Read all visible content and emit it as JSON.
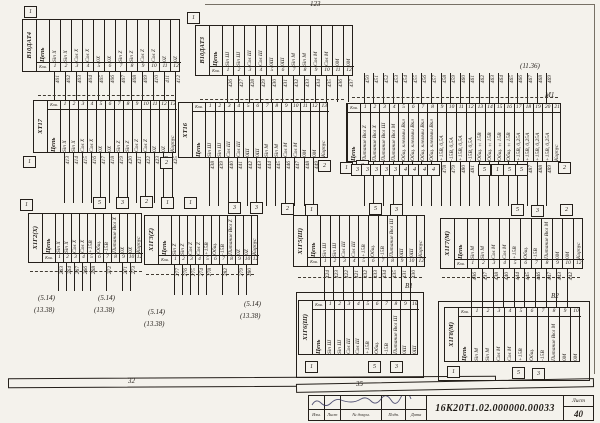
{
  "sheet": {
    "doc_number": "16К20Т1.02.000000.00033",
    "sheet_label": "Лист",
    "sheet_number": "40",
    "stamp_cols": [
      "Изм.",
      "Лист",
      "№ докум.",
      "Подп.",
      "Дата"
    ],
    "ink_color": "#241f1a",
    "paper_color": "#f4f2ec"
  },
  "tables": [
    {
      "id": "v10dat4",
      "name": "В10ДАТ4",
      "x": 22,
      "y": 19,
      "colw": 11,
      "body_h": 44,
      "pin_row": 9,
      "pins_side": "bottom",
      "header": "Цепь",
      "pin_header": "Кон.",
      "pins": [
        "1",
        "2",
        "3",
        "4",
        "5",
        "6",
        "7",
        "8",
        "9",
        "10",
        "11",
        "12"
      ],
      "circuits": [
        "Sin X",
        "Sin X",
        "Cos X",
        "Cos X",
        "0X",
        "0X",
        "Sin Z",
        "Sin Z",
        "Cos Z",
        "Cos Z",
        "0Z",
        "0Z"
      ],
      "wires_top": null,
      "wires_bottom": {
        "len": 28,
        "nums": [
          "401",
          "402",
          "403",
          "404",
          "405",
          "406",
          "407",
          "408",
          "409",
          "410",
          "411",
          "412"
        ]
      }
    },
    {
      "id": "v10dat3",
      "name": "В10ДАТ3",
      "x": 195,
      "y": 25,
      "colw": 11,
      "body_h": 42,
      "pin_row": 9,
      "pins_side": "bottom",
      "header": "Цепь",
      "pin_header": "Кон.",
      "pins": [
        "1",
        "2",
        "3",
        "4",
        "5",
        "6",
        "7",
        "8",
        "9",
        "10",
        "11",
        "12"
      ],
      "circuits": [
        "Sin Ш",
        "Sin Ш",
        "Cos Ш",
        "Cos Ш",
        "0Ш",
        "0Ш",
        "Sin M",
        "Sin M",
        "Cos M",
        "Cos M",
        "0M",
        "0M"
      ],
      "wires_top": null,
      "wires_bottom": {
        "len": 26,
        "nums": [
          "426",
          "427",
          "428",
          "429",
          "430",
          "431",
          "432",
          "433",
          "434",
          "435",
          "436",
          "437"
        ]
      }
    },
    {
      "id": "xt17",
      "name": "ХТ17",
      "x": 33,
      "y": 100,
      "colw": 9,
      "body_h": 44,
      "pin_row": 9,
      "pins_side": "top",
      "header": "Цепь",
      "pin_header": "Кон.",
      "pins": [
        "1",
        "2",
        "3",
        "4",
        "5",
        "6",
        "7",
        "8",
        "9",
        "10",
        "11",
        "12",
        "13"
      ],
      "circuits": [
        "Sin X",
        "Sin X",
        "Cos X",
        "Cos X",
        "0X",
        "0X",
        "Sin Z",
        "Sin Z",
        "Cos Z",
        "Cos Z",
        "0Z",
        "0Z",
        "Корпус"
      ],
      "wires_top": null,
      "wires_bottom": {
        "len": 50,
        "nums": [
          "413",
          "414",
          "415",
          "416",
          "417",
          "418",
          "419",
          "420",
          "421",
          "422",
          "423",
          "424",
          "425"
        ]
      }
    },
    {
      "id": "xt16",
      "name": "ХТ16",
      "x": 178,
      "y": 102,
      "colw": 9.5,
      "body_h": 47,
      "pin_row": 9,
      "pins_side": "top",
      "header": "Цепь",
      "pin_header": "Кон.",
      "pins": [
        "1",
        "2",
        "3",
        "4",
        "5",
        "6",
        "7",
        "8",
        "9",
        "10",
        "11",
        "12",
        "13"
      ],
      "circuits": [
        "Sin Ш",
        "Sin Ш",
        "Cos Ш",
        "Cos Ш",
        "0Ш",
        "0Ш",
        "Sin M",
        "Sin M",
        "Cos M",
        "Cos M",
        "0M",
        "0M",
        "Корпус"
      ],
      "wires_top": null,
      "wires_bottom": {
        "len": 48,
        "nums": [
          "438",
          "439",
          "440",
          "441",
          "442",
          "443",
          "444",
          "445",
          "446",
          "447",
          "448",
          "449",
          null
        ]
      }
    },
    {
      "id": "m1",
      "name": null,
      "x": 346,
      "y": 103,
      "colw": 9.6,
      "body_h": 50,
      "pin_row": 9,
      "pins_side": "top",
      "header": "Цепь",
      "pin_header": "Кон.",
      "pins": [
        "1",
        "2",
        "3",
        "4",
        "5",
        "6",
        "7",
        "8",
        "9",
        "10",
        "11",
        "12",
        "13",
        "14",
        "15",
        "16",
        "17",
        "18",
        "19",
        "20",
        "21"
      ],
      "circuits": [
        "Питание Вкл Z",
        "Питание Вкл X",
        "Питание Вкл Ш",
        "Питание Вкл М",
        "Общ. клеммы Вкл",
        "Общ. клеммы Вкл",
        "Общ. клеммы Вкл",
        "Общ. клеммы Вкл",
        "+15В, 0,5А",
        "-15В, 0,5А",
        "+15В, 0,5А",
        "-15В, 0,5А",
        "Общ. ±15В",
        "Общ. ±15В",
        "Общ. ±15В",
        "Общ. ±15В",
        "+15В, 0,25А",
        "+15В, 0,25А",
        "+15В, 0,25А",
        "+15В, 0,25А",
        "Корпус"
      ],
      "wires_top": {
        "len": 30,
        "nums": [
          "450",
          "451",
          "452",
          "453",
          "454",
          "455",
          "456",
          "457",
          "458",
          "459",
          "460",
          "461",
          "462",
          "463",
          "464",
          "465",
          "466",
          "467",
          "468",
          "469",
          null
        ]
      },
      "wires_bottom": {
        "len": 44,
        "nums": [
          "470",
          "471",
          "472",
          "473",
          "474",
          "475",
          "476",
          "477",
          "478",
          "479",
          "480",
          "481",
          "482",
          "483",
          "484",
          "485",
          "486",
          "487",
          "488",
          "489",
          null
        ]
      }
    },
    {
      "id": "x1g2",
      "name": "Х1Г2(Х)",
      "x": 28,
      "y": 213,
      "colw": 8,
      "body_h": 41,
      "pin_row": 9,
      "pins_side": "bottom",
      "header": "Цепь",
      "pin_header": "Кон.",
      "pins": [
        "1",
        "2",
        "3",
        "4",
        "5",
        "6",
        "7",
        "8",
        "9",
        "10",
        "12"
      ],
      "circuits": [
        "Sin X",
        "Sin X",
        "Cos X",
        "Cos X",
        "+15В",
        "Общ.",
        "-15В",
        "Питание Вкл X",
        "0X",
        "0X",
        "Корпус"
      ],
      "wires_top": null,
      "wires_bottom": {
        "len": 28,
        "nums": [
          "263",
          "264",
          "267",
          "266",
          "268",
          null,
          "272",
          null,
          "271",
          "273",
          null
        ]
      }
    },
    {
      "id": "x1g3",
      "name": "Х1Г3(Z)",
      "x": 144,
      "y": 215,
      "colw": 8,
      "body_h": 41,
      "pin_row": 9,
      "pins_side": "bottom",
      "header": "Цепь",
      "pin_header": "Кон.",
      "pins": [
        "1",
        "2",
        "3",
        "4",
        "5",
        "6",
        "7",
        "8",
        "9",
        "10",
        "12"
      ],
      "circuits": [
        "Sin Z",
        "Sin Z",
        "Cos Z",
        "Cos Z",
        "+15В",
        "Общ.",
        "-15В",
        "Питание Вкл Z",
        "0Z",
        "0Z",
        "Корпус"
      ],
      "wires_top": null,
      "wires_bottom": {
        "len": 30,
        "nums": [
          "277",
          "276",
          "275",
          "274",
          "278",
          null,
          "282",
          null,
          "279",
          "280",
          null
        ]
      }
    },
    {
      "id": "x1g5",
      "name": "Х1Г5(Ш)",
      "x": 293,
      "y": 215,
      "colw": 9.6,
      "body_h": 43,
      "pin_row": 9,
      "pins_side": "bottom",
      "header": "Цепь",
      "pin_header": "Кон.",
      "pins": [
        "1",
        "2",
        "3",
        "4",
        "5",
        "6",
        "7",
        "8",
        "9",
        "10",
        "12"
      ],
      "circuits": [
        "Sin Ш",
        "Sin Ш",
        "Cos Ш",
        "Cos Ш",
        "+15В",
        "Общ.",
        "-15В",
        "Питание Вкл Ш",
        "0Ш",
        "0Ш",
        "Корпус"
      ],
      "wires_top": null,
      "wires_bottom": {
        "len": 33,
        "nums": [
          "424",
          "423",
          "422",
          "421",
          "432",
          "433",
          "434",
          "435",
          "431",
          "430",
          null
        ]
      }
    },
    {
      "id": "x1g7",
      "name": "Х1Г7(М)",
      "x": 440,
      "y": 218,
      "colw": 10.6,
      "body_h": 42,
      "pin_row": 9,
      "pins_side": "bottom",
      "header": "Цепь",
      "pin_header": "Кон.",
      "pins": [
        "1",
        "2",
        "3",
        "4",
        "5",
        "6",
        "7",
        "8",
        "9",
        "10",
        "12"
      ],
      "circuits": [
        "Sin M",
        "Sin M",
        "Cos M",
        "Cos M",
        "+15В",
        "Общ.",
        "-15В",
        "Питание Вкл М",
        "0М",
        "0М",
        "Корпус"
      ],
      "wires_top": null,
      "wires_bottom": {
        "len": 38,
        "nums": [
          "436",
          "437",
          "438",
          "440",
          "444",
          "445",
          "446",
          "447",
          "443",
          "442",
          null
        ]
      }
    },
    {
      "id": "x1g6",
      "name": "Х1Г6(Ш)",
      "x": 298,
      "y": 300,
      "colw": 9.4,
      "body_h": 46,
      "pin_row": 9,
      "pins_side": "top",
      "header": "Цепь",
      "pin_header": "Кон.",
      "pins": [
        "1",
        "2",
        "3",
        "4",
        "5",
        "6",
        "7",
        "8",
        "9",
        "10"
      ],
      "circuits": [
        "Sin Ш",
        "Sin Ш",
        "Cos Ш",
        "Cos Ш",
        "+15В",
        "Общ.",
        "-15В",
        "Питание Вкл Ш",
        "0Ш",
        "0Ш"
      ],
      "wires_top": null,
      "wires_bottom": null
    },
    {
      "id": "x1g8",
      "name": "Х1Г8(М)",
      "x": 444,
      "y": 307,
      "colw": 11,
      "body_h": 46,
      "pin_row": 9,
      "pins_side": "top",
      "header": "Цепь",
      "pin_header": "Кон.",
      "pins": [
        "1",
        "2",
        "3",
        "4",
        "5",
        "6",
        "7",
        "8",
        "9",
        "10"
      ],
      "circuits": [
        "Sin M",
        "Sin M",
        "Cos M",
        "Cos M",
        "+15В",
        "Общ.",
        "-15В",
        "Питание Вкл М",
        "0М",
        "0М"
      ],
      "wires_top": null,
      "wires_bottom": null
    }
  ],
  "enclosures": [
    {
      "x": 296,
      "y": 292,
      "w": 128,
      "h": 86
    },
    {
      "x": 438,
      "y": 301,
      "w": 152,
      "h": 80
    }
  ],
  "buses": [
    {
      "x": 38,
      "y": 95,
      "w": 136
    },
    {
      "x": 200,
      "y": 99,
      "w": 144
    },
    {
      "x": 352,
      "y": 97,
      "w": 206
    },
    {
      "x": 30,
      "y": 271,
      "w": 112
    },
    {
      "x": 146,
      "y": 274,
      "w": 108
    },
    {
      "x": 298,
      "y": 277,
      "w": 124
    },
    {
      "x": 442,
      "y": 277,
      "w": 138
    }
  ],
  "junction_boxes": [
    {
      "t": "1",
      "x": 24,
      "y": 6
    },
    {
      "t": "1",
      "x": 187,
      "y": 12
    },
    {
      "t": "1",
      "x": 23,
      "y": 156
    },
    {
      "t": "2",
      "x": 160,
      "y": 157
    },
    {
      "t": "1",
      "x": 184,
      "y": 197
    },
    {
      "t": "1",
      "x": 20,
      "y": 199
    },
    {
      "t": "5",
      "x": 93,
      "y": 197
    },
    {
      "t": "3",
      "x": 116,
      "y": 197
    },
    {
      "t": "2",
      "x": 140,
      "y": 196
    },
    {
      "t": "1",
      "x": 161,
      "y": 197
    },
    {
      "t": "3",
      "x": 228,
      "y": 202
    },
    {
      "t": "3",
      "x": 250,
      "y": 202
    },
    {
      "t": "2",
      "x": 281,
      "y": 203
    },
    {
      "t": "1",
      "x": 305,
      "y": 204
    },
    {
      "t": "2",
      "x": 318,
      "y": 160
    },
    {
      "t": "1",
      "x": 340,
      "y": 162
    },
    {
      "t": "3",
      "x": 356,
      "y": 160
    },
    {
      "t": "3",
      "x": 351,
      "y": 164
    },
    {
      "t": "3",
      "x": 361,
      "y": 164
    },
    {
      "t": "3",
      "x": 370,
      "y": 164
    },
    {
      "t": "3",
      "x": 380,
      "y": 164
    },
    {
      "t": "3",
      "x": 389,
      "y": 164
    },
    {
      "t": "4",
      "x": 399,
      "y": 164
    },
    {
      "t": "4",
      "x": 408,
      "y": 164
    },
    {
      "t": "4",
      "x": 418,
      "y": 164
    },
    {
      "t": "4",
      "x": 427,
      "y": 164
    },
    {
      "t": "5",
      "x": 478,
      "y": 164
    },
    {
      "t": "1",
      "x": 491,
      "y": 164
    },
    {
      "t": "5",
      "x": 503,
      "y": 164
    },
    {
      "t": "5",
      "x": 515,
      "y": 164
    },
    {
      "t": "2",
      "x": 558,
      "y": 162
    },
    {
      "t": "5",
      "x": 369,
      "y": 203
    },
    {
      "t": "3",
      "x": 390,
      "y": 204
    },
    {
      "t": "5",
      "x": 511,
      "y": 204
    },
    {
      "t": "3",
      "x": 531,
      "y": 205
    },
    {
      "t": "2",
      "x": 560,
      "y": 204
    },
    {
      "t": "1",
      "x": 305,
      "y": 361
    },
    {
      "t": "5",
      "x": 368,
      "y": 361
    },
    {
      "t": "3",
      "x": 390,
      "y": 361
    },
    {
      "t": "1",
      "x": 447,
      "y": 366
    },
    {
      "t": "5",
      "x": 512,
      "y": 367
    },
    {
      "t": "3",
      "x": 532,
      "y": 368
    }
  ],
  "refs": [
    {
      "t": "123",
      "x": 310,
      "y": 1
    },
    {
      "t": "(11.36)",
      "x": 520,
      "y": 63
    },
    {
      "t": "М1",
      "x": 545,
      "y": 92
    },
    {
      "t": "В1",
      "x": 405,
      "y": 283
    },
    {
      "t": "В2",
      "x": 551,
      "y": 293
    },
    {
      "t": "(5.14)",
      "x": 38,
      "y": 295
    },
    {
      "t": "(13.38)",
      "x": 34,
      "y": 307
    },
    {
      "t": "(5.14)",
      "x": 98,
      "y": 295
    },
    {
      "t": "(13.38)",
      "x": 94,
      "y": 307
    },
    {
      "t": "(5.14)",
      "x": 148,
      "y": 309
    },
    {
      "t": "(13.38)",
      "x": 144,
      "y": 321
    },
    {
      "t": "(5.14)",
      "x": 244,
      "y": 301
    },
    {
      "t": "(13.38)",
      "x": 240,
      "y": 313
    },
    {
      "t": "32",
      "x": 128,
      "y": 378
    },
    {
      "t": "35",
      "x": 356,
      "y": 381
    }
  ]
}
